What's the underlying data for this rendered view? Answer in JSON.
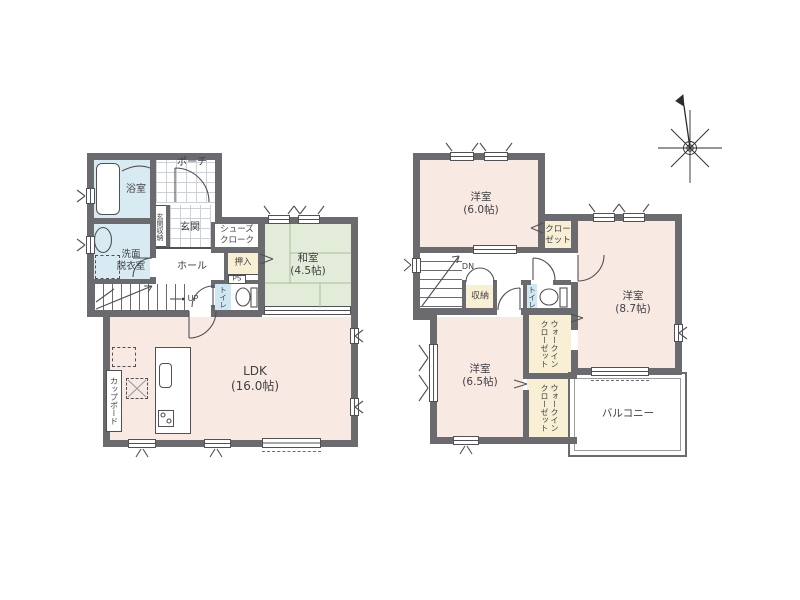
{
  "colors": {
    "wall": "#6a6a6f",
    "line": "#515155",
    "room_pink": "#f8e9e3",
    "tatami_green": "#e3ecd8",
    "water_blue": "#d8eaf2",
    "toilet_door_blue": "#cfe7f2",
    "closet_cream": "#f8efd4",
    "text": "#3f3f44",
    "background": "#ffffff"
  },
  "icons": {
    "compass": "compass-rose-8-point-with-north-needle"
  },
  "floor1": {
    "porch": "ポーチ",
    "bathroom": "浴室",
    "entrance_storage": "玄関収納",
    "entrance": "玄関",
    "shoes_cloak": [
      "シューズ",
      "クローク"
    ],
    "washroom": [
      "洗面",
      "脱衣室"
    ],
    "hall": "ホール",
    "closet": "押入",
    "pipe_space": "PS",
    "toilet": "トイレ",
    "stairs_up": "UP",
    "japanese_room": {
      "name": "和室",
      "size": "(4.5帖)"
    },
    "ldk": {
      "name": "LDK",
      "size": "(16.0帖)"
    },
    "cupboard": "カップボード"
  },
  "floor2": {
    "bedroom_60": {
      "name": "洋室",
      "size": "(6.0帖)"
    },
    "closet": [
      "クロー",
      "ゼット"
    ],
    "stairs_down": "DN",
    "storage": "収納",
    "toilet": "トイレ",
    "bedroom_87": {
      "name": "洋室",
      "size": "(8.7帖)"
    },
    "wic_upper": [
      "ウォークイン",
      "クローゼット"
    ],
    "wic_lower": [
      "ウォークイン",
      "クローゼット"
    ],
    "bedroom_65": {
      "name": "洋室",
      "size": "(6.5帖)"
    },
    "balcony": "バルコニー"
  }
}
